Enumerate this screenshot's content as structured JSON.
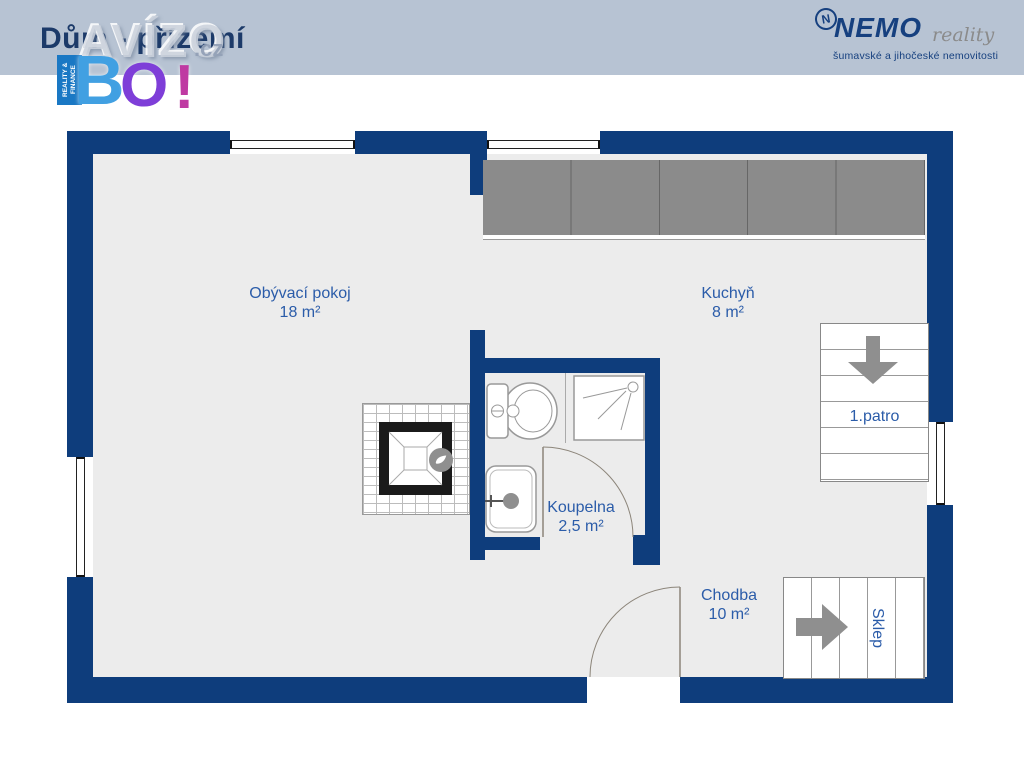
{
  "header": {
    "title": "Dům - přízemí"
  },
  "watermark": {
    "brand": "AVÍZO",
    "tld": ".cz",
    "badge_line1": "REALITY",
    "badge_line2": "& FINANCE",
    "b": "B",
    "o": "O",
    "excl": "!"
  },
  "agency": {
    "icon_letter": "N",
    "name": "NEMO",
    "suffix": "reality",
    "tagline": "šumavské a jihočeské nemovitosti"
  },
  "rooms": {
    "living": {
      "name": "Obývací pokoj",
      "area": "18 m²"
    },
    "kitchen": {
      "name": "Kuchyň",
      "area": "8 m²"
    },
    "bathroom": {
      "name": "Koupelna",
      "area": "2,5 m²"
    },
    "hallway": {
      "name": "Chodba",
      "area": "10 m²"
    }
  },
  "stairs": {
    "up_label": "1.patro",
    "down_label": "Sklep"
  },
  "colors": {
    "wall": "#0e3d7c",
    "floor": "#ececec",
    "counter": "#8b8b8b",
    "room_label": "#2b5ca9",
    "arrow": "#8f8f8f",
    "header_bg": "#b7c3d3",
    "title": "#1c3a69",
    "nemo_blue": "#16407f",
    "avizo_b": "#41a0e2",
    "avizo_o": "#7e3ed8",
    "avizo_excl": "#bf3aa2"
  }
}
